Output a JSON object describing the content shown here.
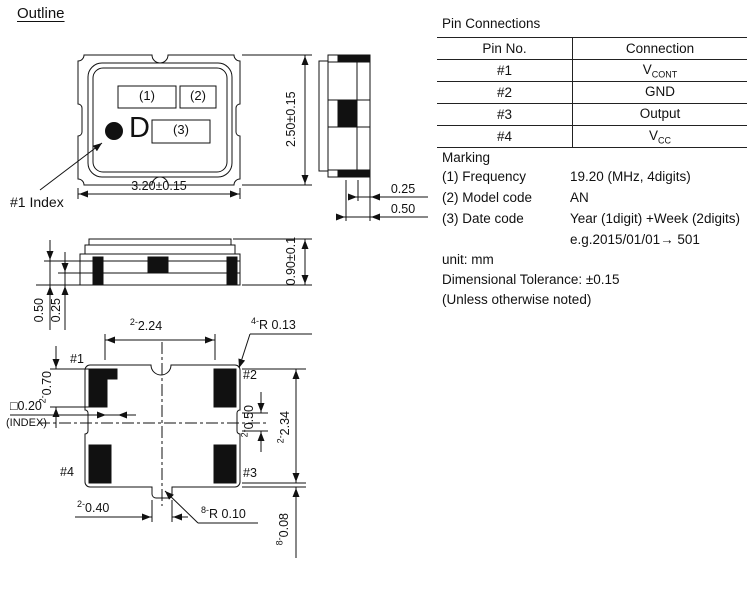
{
  "title": "Outline",
  "pin_connections": {
    "title": "Pin Connections",
    "col_headers": [
      "Pin No.",
      "Connection"
    ],
    "rows": [
      {
        "pin": "#1",
        "conn": "V",
        "conn_sub": "CONT"
      },
      {
        "pin": "#2",
        "conn": "GND",
        "conn_sub": ""
      },
      {
        "pin": "#3",
        "conn": "Output",
        "conn_sub": ""
      },
      {
        "pin": "#4",
        "conn": "V",
        "conn_sub": "CC"
      }
    ]
  },
  "marking": {
    "title": "Marking",
    "rows": [
      {
        "label": "(1) Frequency",
        "value": "19.20 (MHz, 4digits)"
      },
      {
        "label": "(2) Model code",
        "value": "AN"
      },
      {
        "label": "(3) Date code",
        "value": "Year (1digit) +Week (2digits)"
      },
      {
        "label": "",
        "value": "e.g.2015/01/01→ 501"
      }
    ],
    "notes": [
      "unit: mm",
      "Dimensional Tolerance: ±0.15",
      "(Unless otherwise noted)"
    ]
  },
  "top_view": {
    "mark1": "(1)",
    "mark2": "(2)",
    "mark3": "(3)",
    "letter": "D",
    "index_label": "#1 Index",
    "width_dim": "3.20±0.15",
    "height_dim": "2.50±0.15"
  },
  "side_view": {
    "dim_small": "0.25",
    "dim_large": "0.50"
  },
  "front_view": {
    "height_dim": "0.90±0.1",
    "dim_large": "0.50",
    "dim_small": "0.25"
  },
  "bottom_view": {
    "pad1": "#1",
    "pad2": "#2",
    "pad3": "#3",
    "pad4": "#4",
    "index_size": "□0.20",
    "index_note": "(INDEX)",
    "pad_height": {
      "n": "2-",
      "v": "0.70"
    },
    "top_width": {
      "n": "2-",
      "v": "2.24"
    },
    "corner_radius": {
      "n": "4-",
      "v": "R 0.13"
    },
    "notch_height": {
      "n": "2-",
      "v": "0.50"
    },
    "pad_span": {
      "n": "2-",
      "v": "2.34"
    },
    "slot_width": {
      "n": "2-",
      "v": "0.40"
    },
    "notch_radius": {
      "n": "8-",
      "v": "R 0.10"
    },
    "pad_inset": {
      "n": "8-",
      "v": "0.08"
    }
  }
}
